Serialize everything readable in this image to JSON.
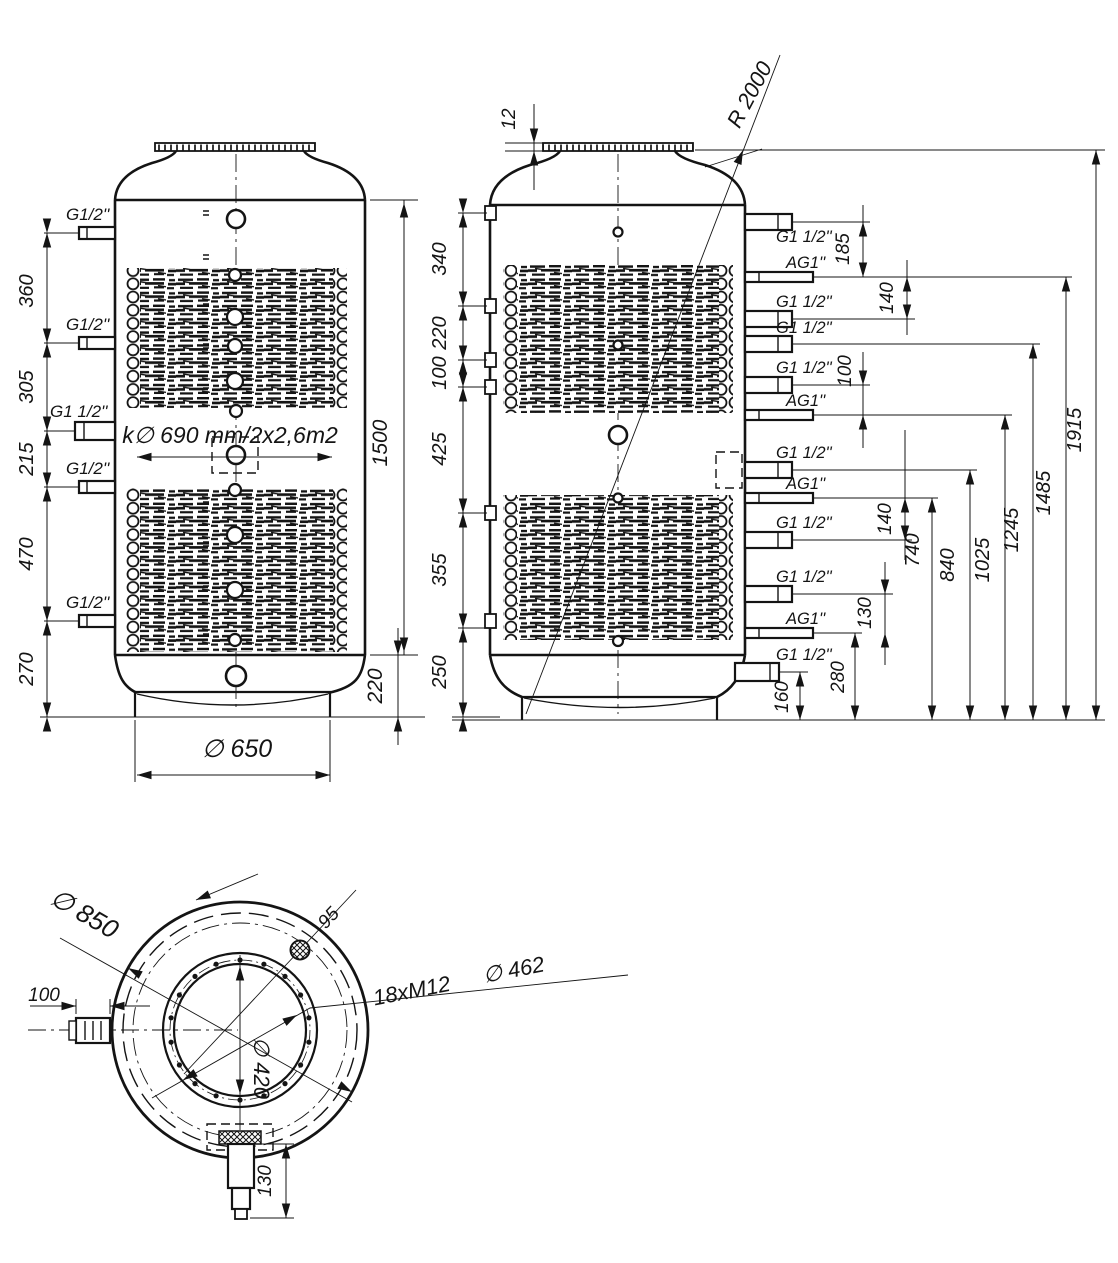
{
  "front_view": {
    "port_labels": [
      "G1/2''",
      "G1/2''",
      "G1 1/2''",
      "G1/2''",
      "G1/2''"
    ],
    "dims_left": [
      "360",
      "305",
      "215",
      "470",
      "270"
    ],
    "coil_label": "k∅ 690 mm/2x2,6m2",
    "dim_shell_height": "1500",
    "dim_base_height": "220",
    "dim_base_diameter": "∅  650"
  },
  "side_view": {
    "dim_flange_thickness": "12",
    "dim_dome_radius": "R 2000",
    "dims_left": [
      "340",
      "220",
      "100",
      "425",
      "355",
      "250"
    ],
    "port_labels": [
      "G1 1/2''",
      "AG1''",
      "G1 1/2''",
      "G1 1/2''",
      "G1 1/2''",
      "AG1''",
      "G1 1/2''",
      "AG1''",
      "G1 1/2''",
      "G1 1/2''",
      "AG1''",
      "G1 1/2''"
    ],
    "dims_right_small": [
      "185",
      "140",
      "100",
      "140",
      "130",
      "280",
      "160"
    ],
    "dims_right_chain": [
      "740",
      "840",
      "1025",
      "1245",
      "1485",
      "1915"
    ]
  },
  "bottom_view": {
    "dim_outer_diameter": "∅  850",
    "dim_side_port": "100",
    "dim_hole_offset": "95",
    "bolt_count_label": "18xM12",
    "dim_bolt_circle": "∅  462",
    "dim_inner_diameter": "∅  420",
    "dim_drain_length": "130"
  }
}
